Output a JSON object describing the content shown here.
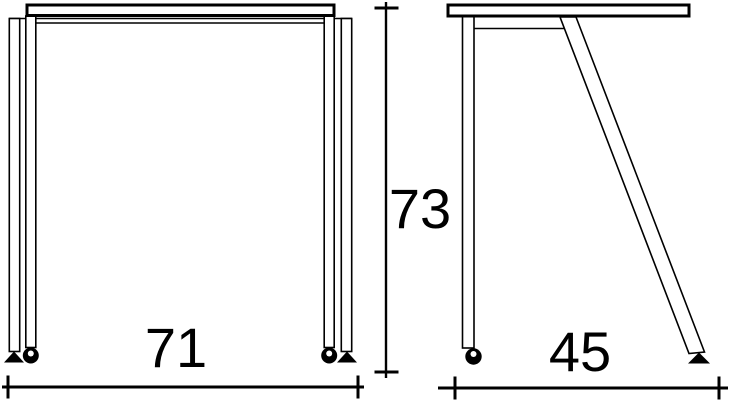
{
  "drawing": {
    "background_color": "#ffffff",
    "line_color": "#000000",
    "dimensions": {
      "width_label": "71",
      "height_label": "73",
      "depth_label": "45"
    }
  }
}
